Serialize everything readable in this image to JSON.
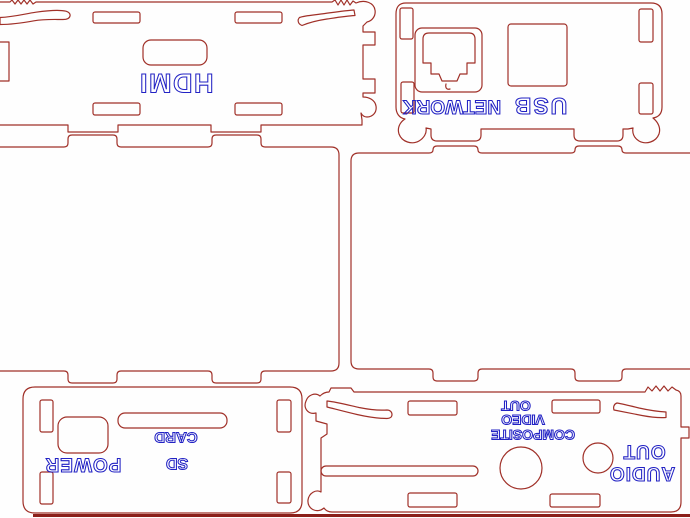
{
  "colors": {
    "outline": "#a03028",
    "ink": "#2222c4",
    "baseline": "#8b1f1a",
    "background": "#fefefe"
  },
  "panels": {
    "hdmi": {
      "label": "HDMI"
    },
    "usb_network": {
      "network_label": "NETWORK",
      "usb_label": "USB"
    },
    "power_sd": {
      "power_label": "POWER",
      "sd_line1": "SD",
      "sd_line2": "CARD"
    },
    "av": {
      "composite_line1": "COMPOSITE",
      "composite_line2": "VIDEO",
      "composite_line3": "OUT",
      "audio_line1": "AUDIO",
      "audio_line2": "OUT"
    }
  }
}
